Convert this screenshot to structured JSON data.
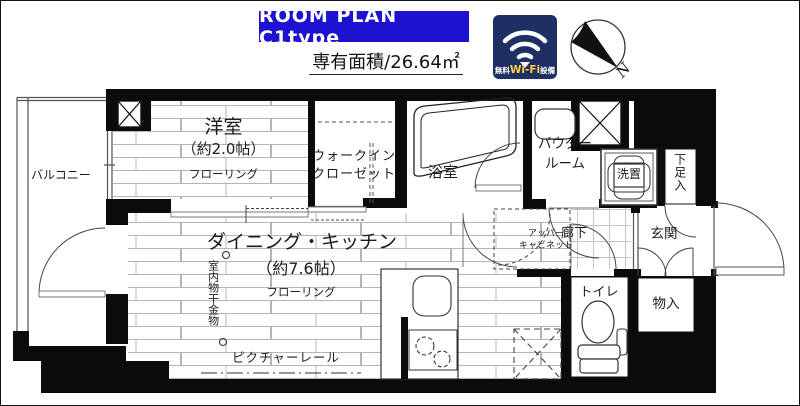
{
  "header": {
    "room_plan_label": "ROOM PLAN C1type",
    "area_label": "専有面積/26.64㎡",
    "wifi_badge": {
      "prefix": "無料",
      "wifi": "Wi-Fi",
      "suffix": "設備"
    },
    "compass_n": "N"
  },
  "colors": {
    "room_plan_bg": "#1d12cf",
    "wifi_bg": "#1e2f63",
    "wifi_accent": "#ffd23f",
    "wall": "#0b0b0b"
  },
  "rooms": {
    "balcony": {
      "label": "バルコニー"
    },
    "western_room": {
      "name": "洋室",
      "size": "（約2.0帖）",
      "floor": "フローリング"
    },
    "wic": {
      "line1": "ウォークイン",
      "line2": "クローゼット"
    },
    "bath": {
      "label": "浴室"
    },
    "powder": {
      "line1": "パウダー",
      "line2": "ルーム"
    },
    "washer": {
      "label": "洗置"
    },
    "shoe": {
      "label": "下足入"
    },
    "dk": {
      "name": "ダイニング・キッチン",
      "size": "（約7.6帖）",
      "floor": "フローリング"
    },
    "corridor": {
      "label": "廊下"
    },
    "entrance": {
      "label": "玄関"
    },
    "toilet": {
      "label": "トイレ"
    },
    "storage": {
      "label": "物入"
    },
    "upper_cabinet": {
      "line1": "アッパー",
      "line2": "キャビネット"
    },
    "laundry_hardware": {
      "label": "室内物干金物"
    },
    "picture_rail": {
      "label": "ピクチャーレール"
    }
  }
}
